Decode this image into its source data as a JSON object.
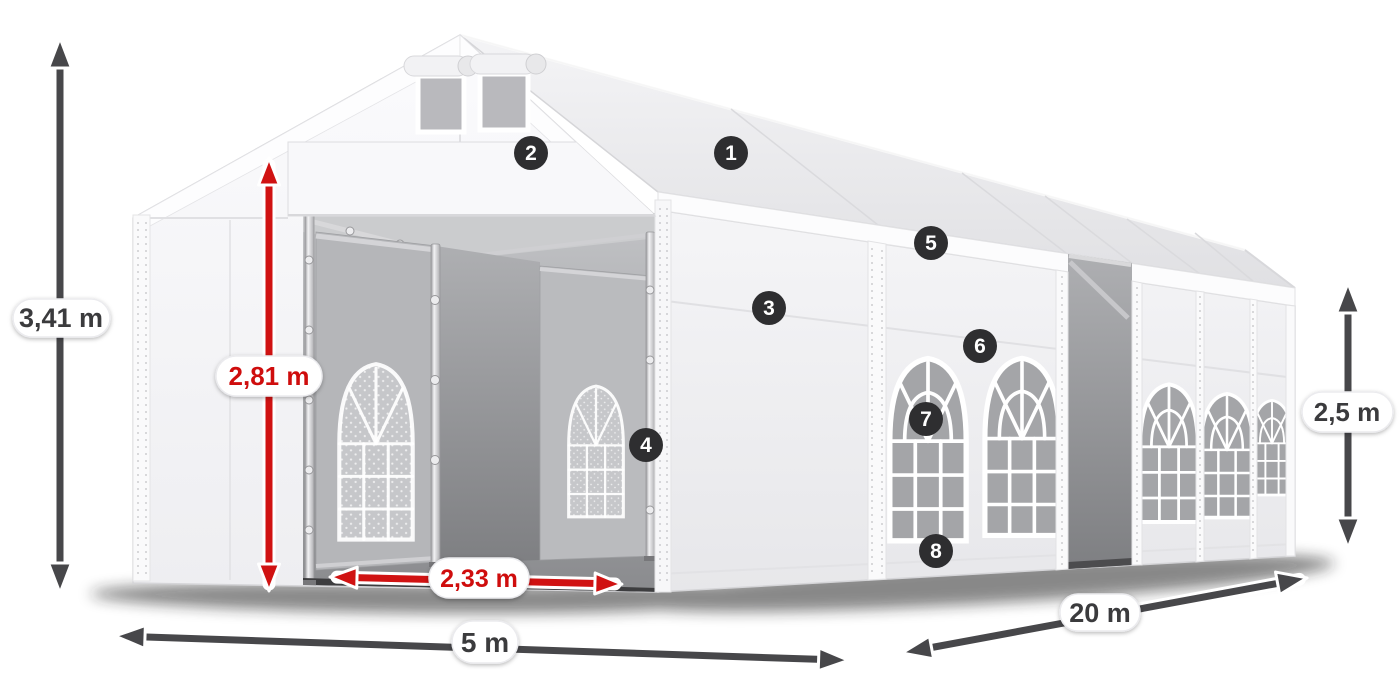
{
  "product_diagram": {
    "measurements": {
      "total_height": "3,41 m",
      "entrance_height": "2,81 m",
      "entrance_width": "2,33 m",
      "front_width": "5 m",
      "side_length": "20 m",
      "wall_height": "2,5 m"
    },
    "feature_markers": [
      "1",
      "2",
      "3",
      "4",
      "5",
      "6",
      "7",
      "8"
    ],
    "colors": {
      "dimension_arrow": "#47474a",
      "dimension_text": "#3b3b3e",
      "accent_arrow": "#d01212",
      "accent_text": "#cf1111",
      "badge_background": "#2e2e30",
      "badge_text": "#ffffff",
      "label_background": "#ffffff"
    }
  }
}
